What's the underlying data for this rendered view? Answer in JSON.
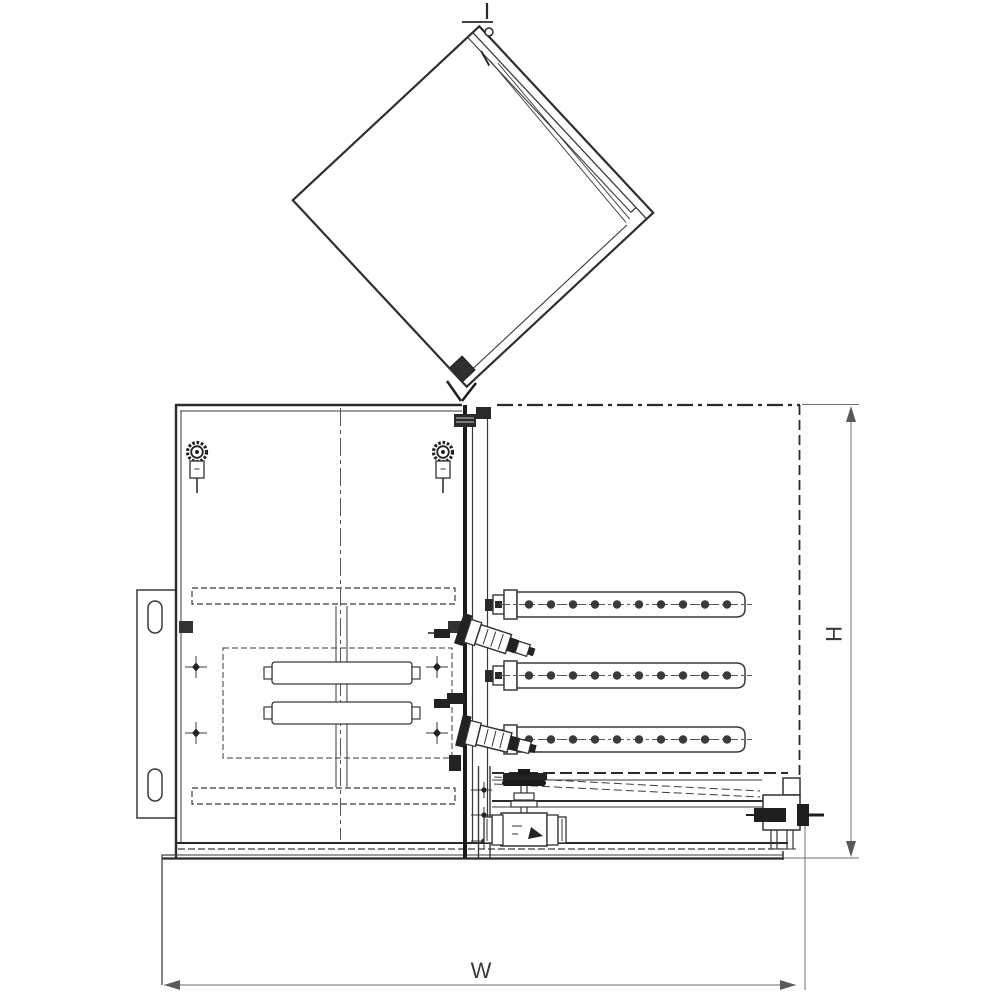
{
  "drawing": {
    "kind": "monochrome technical line drawing, front elevation",
    "labels": {
      "width": "W",
      "height": "H"
    },
    "colors": {
      "background": "#ffffff",
      "line": "#3a3a3a",
      "heavy_line": "#1f1f1f",
      "hidden_line": "#2a2a2a",
      "centerline": "#555555",
      "dimension": "#6f6f6f",
      "label_text": "#3a3a3a"
    },
    "components": [
      "open-lid",
      "lid-hinge",
      "cabinet-body",
      "left-door-panel",
      "toggle-clamp-left",
      "toggle-clamp-right",
      "wall-mount-bracket",
      "center-post-pipe",
      "spray-bar-1",
      "spray-bar-2",
      "spray-bar-3",
      "valve-assembly-upper",
      "valve-assembly-lower",
      "gate-valve",
      "drain-fitting",
      "drain-tray",
      "base-pedestal",
      "width-dimension",
      "height-dimension"
    ]
  }
}
